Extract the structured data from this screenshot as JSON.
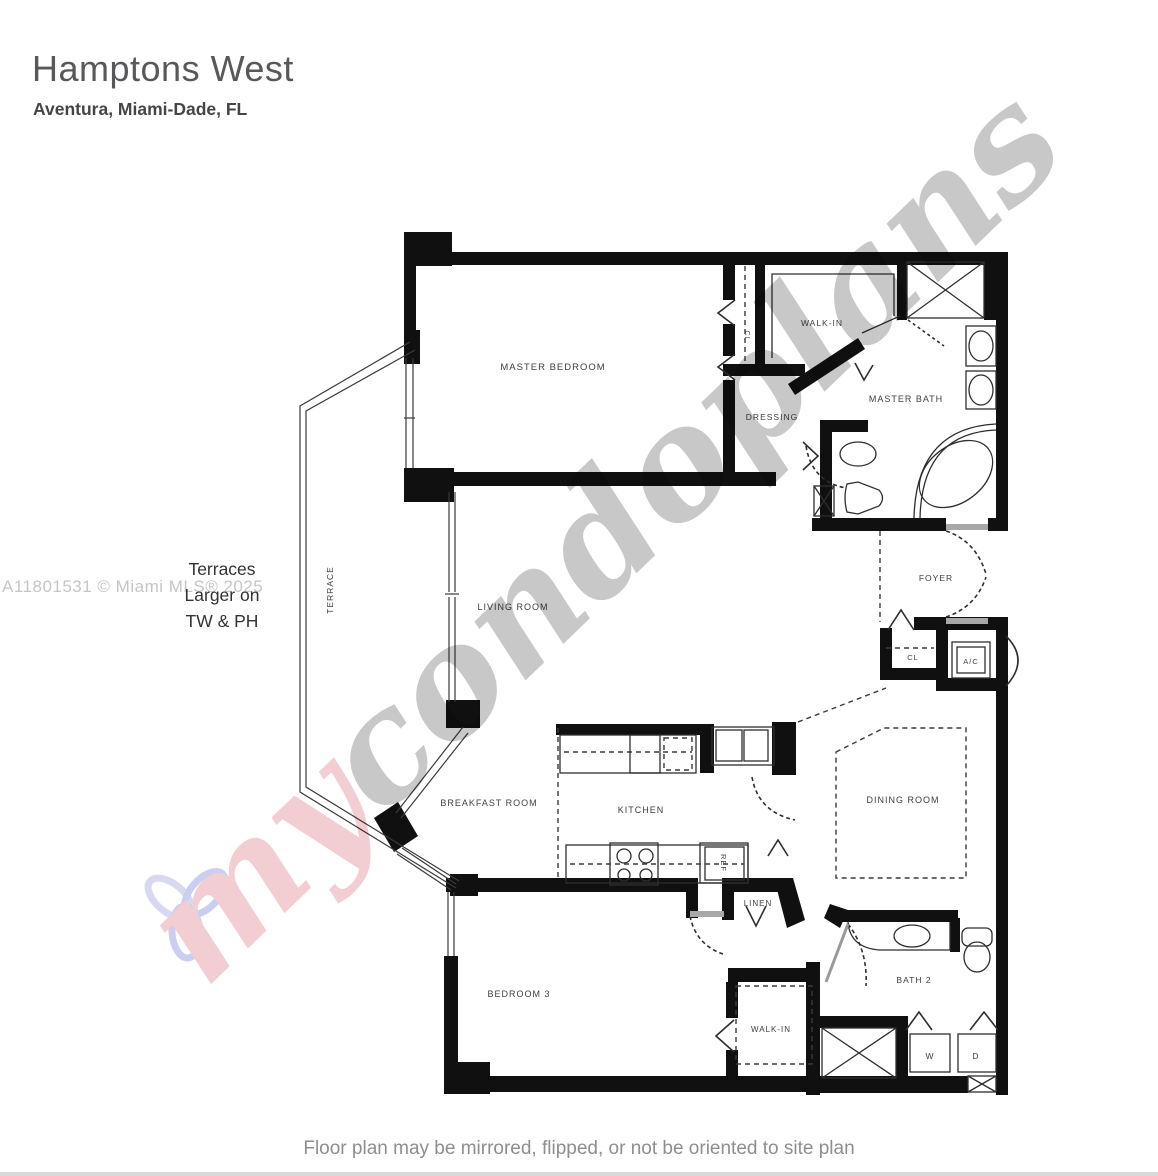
{
  "header": {
    "title": "Hamptons West",
    "subtitle": "Aventura, Miami-Dade, FL"
  },
  "side_notes": {
    "mls": "A11801531 © Miami MLS® 2025",
    "terrace_line1": "Terraces",
    "terrace_line2": "Larger on",
    "terrace_line3": "TW & PH"
  },
  "footer": {
    "disclaimer": "Floor plan may be mirrored, flipped, or not be oriented to site plan"
  },
  "watermark": {
    "prefix": "my",
    "suffix": "condoplans",
    "prefix_color": "#e8a3ad",
    "suffix_color": "#9a9a9a",
    "logo_petal_color": "#9fa6e6",
    "logo_petal_alt_color": "#b6b9e8"
  },
  "plan": {
    "labels": {
      "master_bedroom": "MASTER BEDROOM",
      "walk_in_master": "WALK-IN",
      "dressing": "DRESSING",
      "master_bath": "MASTER BATH",
      "foyer": "FOYER",
      "closet_foyer": "CL",
      "closet_master": "CL",
      "ac": "A/C",
      "living_room": "LIVING ROOM",
      "terrace": "TERRACE",
      "breakfast_room": "BREAKFAST ROOM",
      "kitchen": "KITCHEN",
      "dining_room": "DINING  ROOM",
      "linen": "LINEN",
      "ref": "REF",
      "bedroom3": "BEDROOM 3",
      "walk_in_bedroom3": "WALK-IN",
      "bath2": "BATH 2",
      "washer": "W",
      "dryer": "D"
    }
  }
}
